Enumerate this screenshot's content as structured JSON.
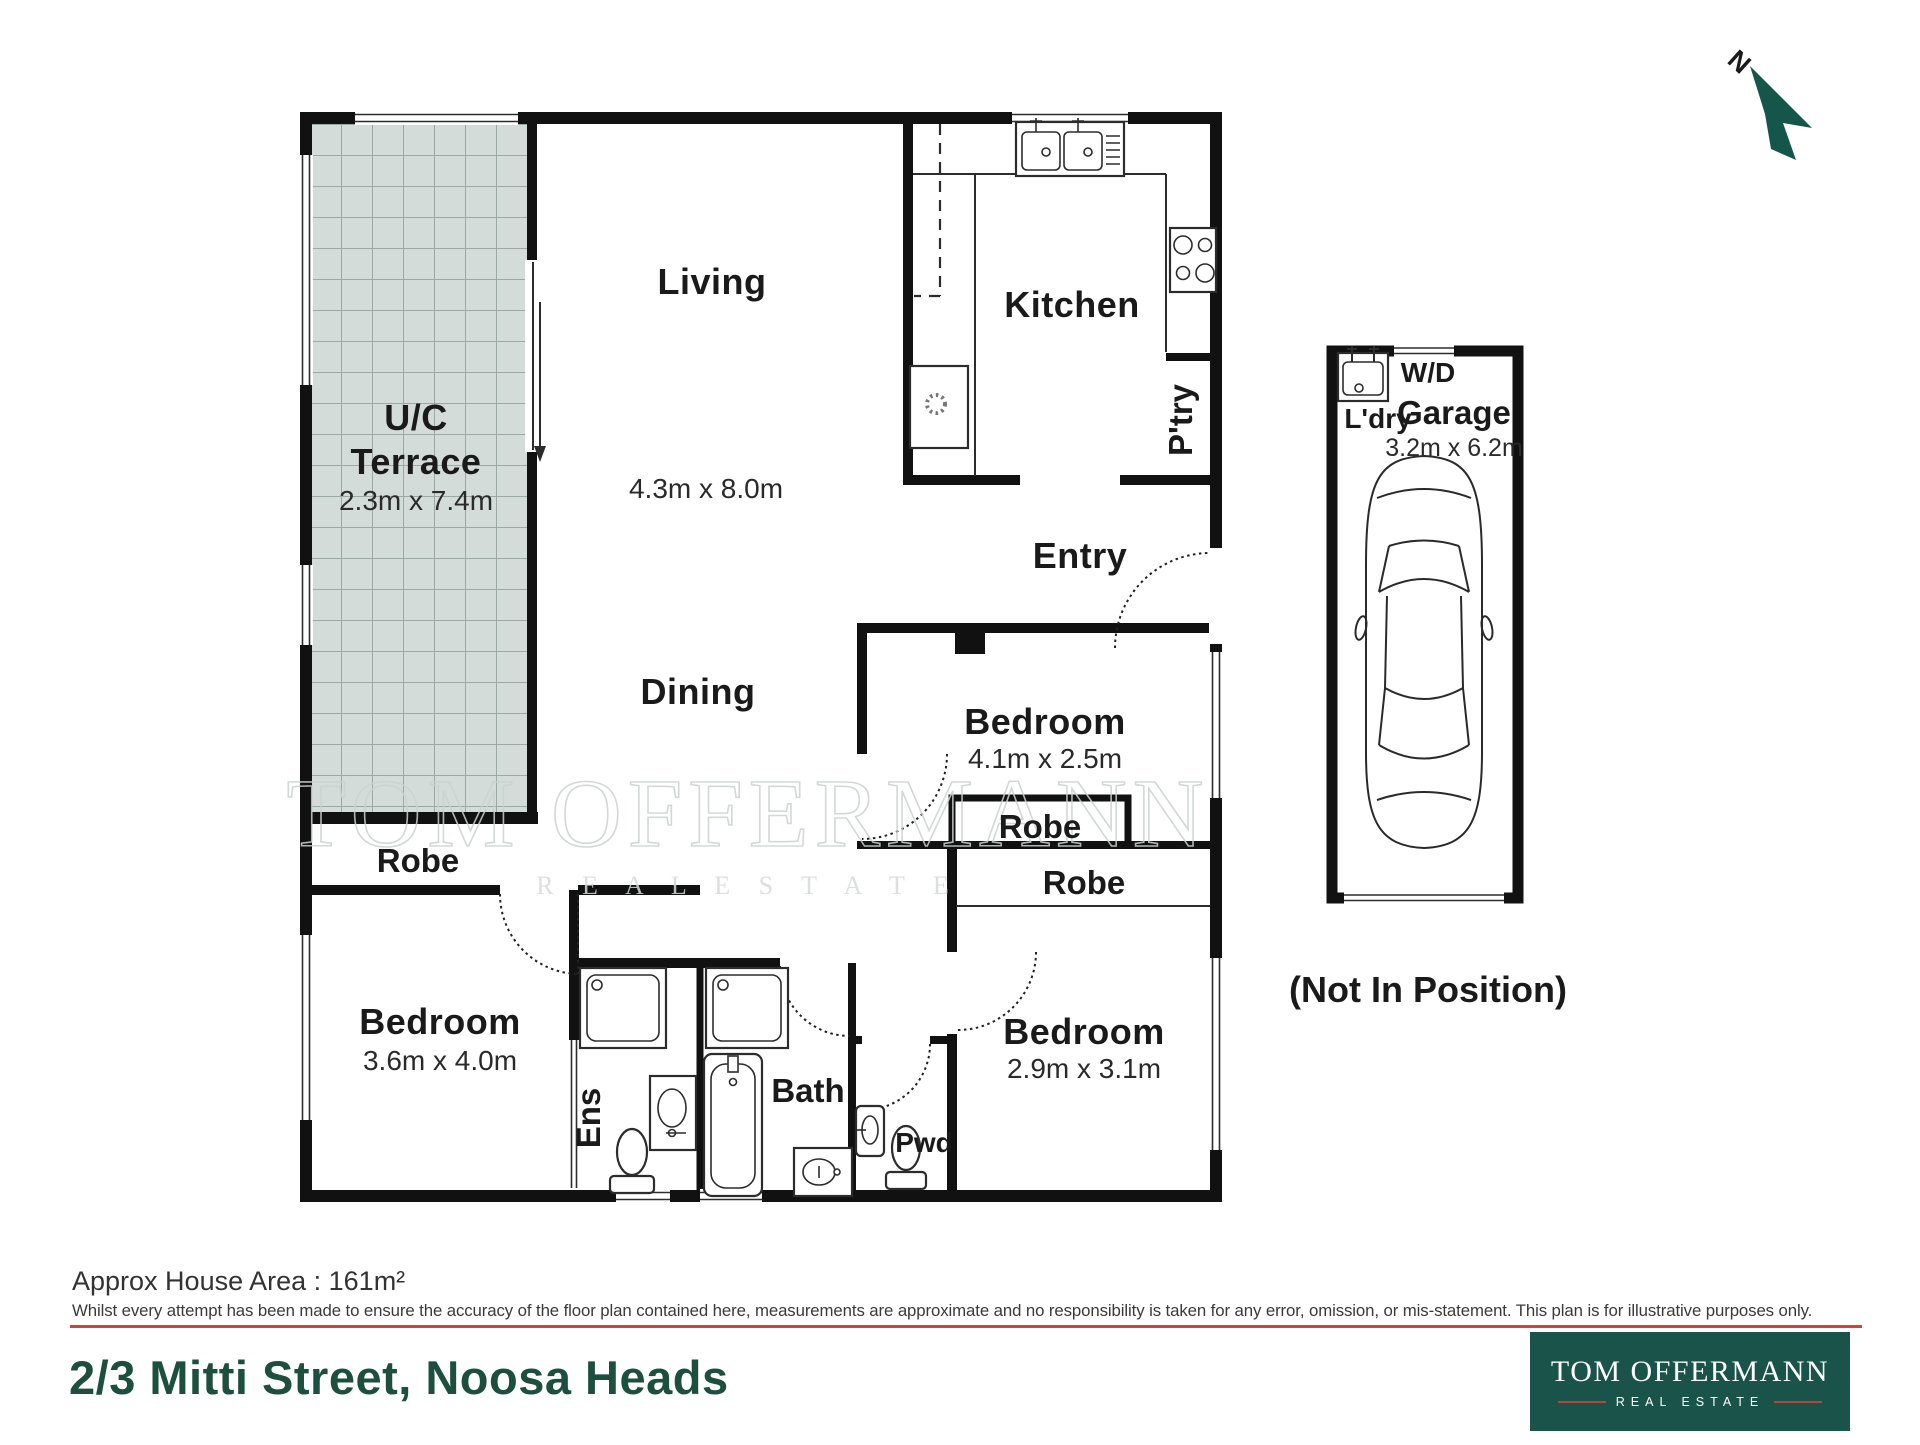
{
  "plan": {
    "north_label": "N",
    "rooms": {
      "terrace_line1": "U/C",
      "terrace_line2": "Terrace",
      "terrace_dims": "2.3m x 7.4m",
      "living": "Living",
      "living_dims": "4.3m x 8.0m",
      "kitchen": "Kitchen",
      "pantry": "P'try",
      "entry": "Entry",
      "dining": "Dining",
      "bed1": "Bedroom",
      "bed1_dims": "4.1m x 2.5m",
      "robe_left": "Robe",
      "robe1": "Robe",
      "robe2": "Robe",
      "bed2": "Bedroom",
      "bed2_dims": "2.9m x 3.1m",
      "bed3": "Bedroom",
      "bed3_dims": "3.6m x 4.0m",
      "ens": "Ens",
      "bath": "Bath",
      "pwd": "Pwd",
      "wd": "W/D",
      "laundry": "L'dry",
      "garage": "Garage",
      "garage_dims": "3.2m x 6.2m",
      "not_in_position": "(Not In Position)"
    }
  },
  "watermark": {
    "line1": "TOM OFFERMANN",
    "line2": "R E A L   E S T A T E"
  },
  "footer": {
    "area_text": "Approx House Area : 161m²",
    "disclaimer": "Whilst every attempt has been made to ensure the accuracy of the floor plan contained here, measurements are approximate and no responsibility is taken for any error, omission, or mis-statement. This plan is for illustrative purposes only.",
    "address": "2/3 Mitti Street, Noosa Heads"
  },
  "logo": {
    "line1": "TOM OFFERMANN",
    "line2": "REAL ESTATE"
  },
  "colors": {
    "brand_green": "#1a5349",
    "address_green": "#1c4f3e",
    "rule_red": "#c9453e",
    "logo_rule_red": "#b0463c",
    "terrace_fill": "#d3dcd8",
    "terrace_grid": "#9ba8a4",
    "watermark_gray": "#ccd2cf",
    "wall_black": "#111111"
  }
}
